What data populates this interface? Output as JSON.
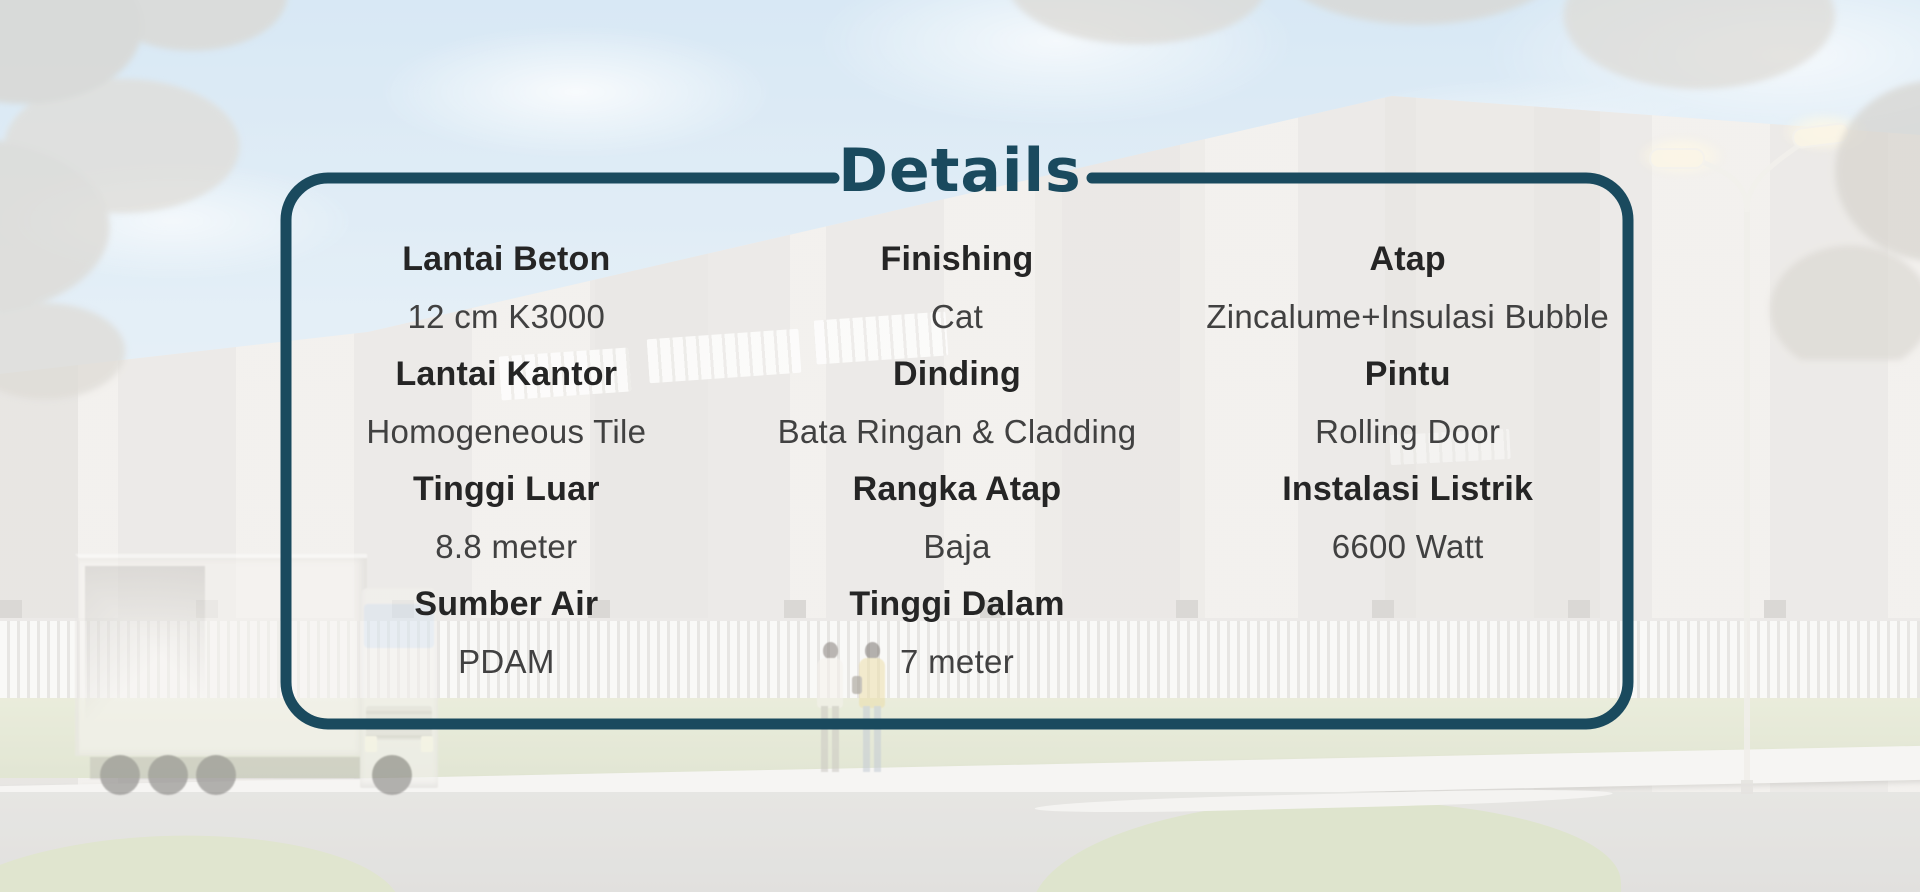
{
  "title": "Details",
  "columns": [
    {
      "items": [
        {
          "label": "Lantai Beton",
          "value": "12 cm K3000"
        },
        {
          "label": "Lantai Kantor",
          "value": "Homogeneous Tile"
        },
        {
          "label": "Tinggi Luar",
          "value": "8.8 meter"
        },
        {
          "label": "Sumber Air",
          "value": "PDAM"
        }
      ]
    },
    {
      "items": [
        {
          "label": "Finishing",
          "value": "Cat"
        },
        {
          "label": "Dinding",
          "value": "Bata Ringan & Cladding"
        },
        {
          "label": "Rangka Atap",
          "value": "Baja"
        },
        {
          "label": "Tinggi Dalam",
          "value": "7 meter"
        }
      ]
    },
    {
      "items": [
        {
          "label": "Atap",
          "value": "Zincalume+Insulasi Bubble"
        },
        {
          "label": "Pintu",
          "value": "Rolling Door"
        },
        {
          "label": "Instalasi Listrik",
          "value": "6600 Watt"
        }
      ]
    }
  ],
  "colors": {
    "accent": "#1a4a5e",
    "label_text": "#252525",
    "value_text": "#414141"
  }
}
